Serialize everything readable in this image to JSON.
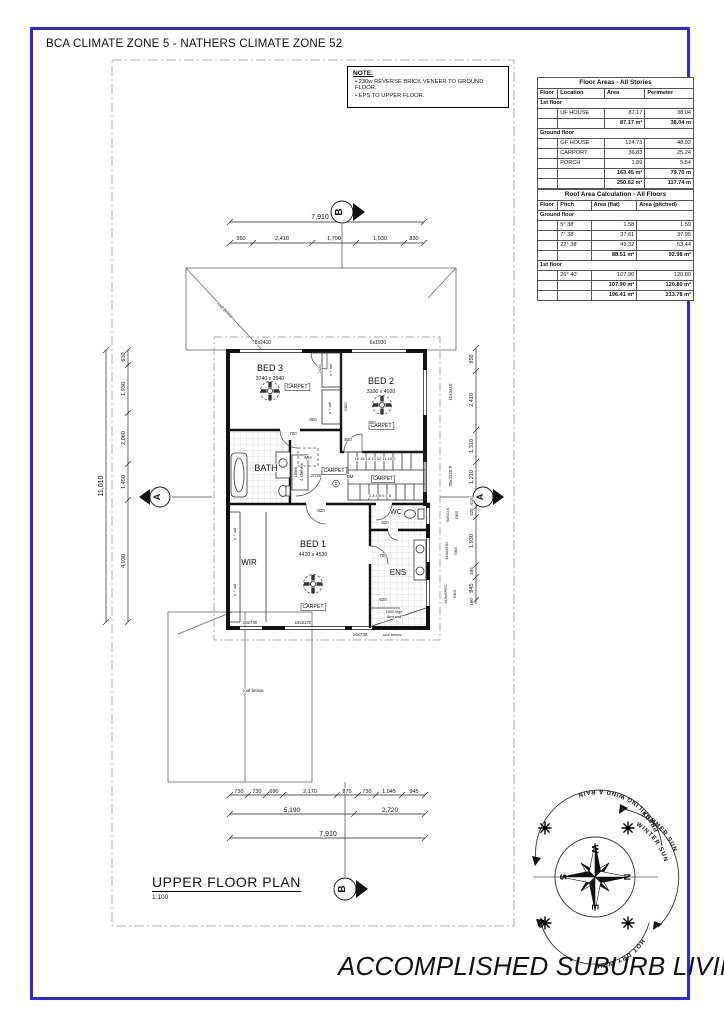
{
  "page": {
    "border_color": "#2b2bdd"
  },
  "header": {
    "text": "BCA CLIMATE ZONE 5 - NATHERS CLIMATE ZONE 52"
  },
  "note": {
    "title": "NOTE:",
    "items": [
      "230w REVERSE BRICK VENEER TO GROUND FLOOR.",
      "EPS TO UPPER FLOOR."
    ]
  },
  "tables": {
    "floor_areas": {
      "title": "Floor Areas - All Stories",
      "columns": [
        "Floor",
        "Location",
        "Area",
        "Perimeter"
      ],
      "rows": [
        {
          "type": "section",
          "label": "1st floor"
        },
        {
          "type": "data",
          "cells": [
            "",
            "UF HOUSE",
            "87.17",
            "38.04"
          ]
        },
        {
          "type": "subtotal",
          "cells": [
            "",
            "",
            "87.17 m²",
            "38.04 m"
          ]
        },
        {
          "type": "section",
          "label": "Ground floor"
        },
        {
          "type": "data",
          "cells": [
            "",
            "GF HOUSE",
            "124.73",
            "48.92"
          ]
        },
        {
          "type": "data",
          "cells": [
            "",
            "CARPORT",
            "36.83",
            "25.24"
          ]
        },
        {
          "type": "data",
          "cells": [
            "",
            "PORCH",
            "1.89",
            "5.54"
          ]
        },
        {
          "type": "subtotal",
          "cells": [
            "",
            "",
            "163.45 m²",
            "79.70 m"
          ]
        },
        {
          "type": "total",
          "cells": [
            "",
            "",
            "250.62 m²",
            "117.74 m"
          ]
        }
      ]
    },
    "roof_areas": {
      "title": "Roof Area Calculation - All Floors",
      "columns": [
        "Floor",
        "Pitch",
        "Area (flat)",
        "Area (pitched)"
      ],
      "rows": [
        {
          "type": "section",
          "label": "Ground floor"
        },
        {
          "type": "data",
          "cells": [
            "",
            "5° 38'",
            "1.58",
            "1.59"
          ]
        },
        {
          "type": "data",
          "cells": [
            "",
            "7° 38'",
            "37.61",
            "37.95"
          ]
        },
        {
          "type": "data",
          "cells": [
            "",
            "22° 38'",
            "49.32",
            "53.44"
          ]
        },
        {
          "type": "subtotal",
          "cells": [
            "",
            "",
            "88.51 m²",
            "92.98 m²"
          ]
        },
        {
          "type": "section",
          "label": "1st floor"
        },
        {
          "type": "data",
          "cells": [
            "",
            "26° 40'",
            "107.90",
            "120.80"
          ]
        },
        {
          "type": "subtotal",
          "cells": [
            "",
            "",
            "107.90 m²",
            "120.80 m²"
          ]
        },
        {
          "type": "total",
          "cells": [
            "",
            "",
            "196.41 m²",
            "213.78 m²"
          ]
        }
      ]
    }
  },
  "plan": {
    "title": "UPPER FLOOR PLAN",
    "scale": "1:100",
    "labels": [
      {
        "t": "7,910",
        "x": 320,
        "y": 219,
        "s": 7,
        "n": "dim-top-overall"
      },
      {
        "t": "950",
        "x": 241,
        "y": 240,
        "s": 5.5,
        "n": "dim-top"
      },
      {
        "t": "2,410",
        "x": 282,
        "y": 240,
        "s": 5.5,
        "n": "dim-top"
      },
      {
        "t": "1,790",
        "x": 334,
        "y": 240,
        "s": 5.5,
        "n": "dim-top"
      },
      {
        "t": "1,930",
        "x": 380,
        "y": 240,
        "s": 5.5,
        "n": "dim-top"
      },
      {
        "t": "830",
        "x": 414,
        "y": 240,
        "s": 5.5,
        "n": "dim-top"
      },
      {
        "t": "11,010",
        "x": 103,
        "y": 486,
        "r": -90,
        "s": 7,
        "n": "dim-left-overall"
      },
      {
        "t": "610",
        "x": 125,
        "y": 357,
        "r": -90,
        "s": 5.5,
        "n": "dim-left"
      },
      {
        "t": "1,930",
        "x": 125,
        "y": 389,
        "r": -90,
        "s": 5.5,
        "n": "dim-left"
      },
      {
        "t": "2,060",
        "x": 125,
        "y": 438,
        "r": -90,
        "s": 5.5,
        "n": "dim-left"
      },
      {
        "t": "1,450",
        "x": 125,
        "y": 482,
        "r": -90,
        "s": 5.5,
        "n": "dim-left"
      },
      {
        "t": "4,930",
        "x": 125,
        "y": 561,
        "r": -90,
        "s": 5.5,
        "n": "dim-left"
      },
      {
        "t": "950",
        "x": 473,
        "y": 359,
        "r": -90,
        "s": 5.5,
        "n": "dim-right"
      },
      {
        "t": "2,410",
        "x": 473,
        "y": 400,
        "r": -90,
        "s": 5.5,
        "n": "dim-right"
      },
      {
        "t": "1,310",
        "x": 473,
        "y": 446,
        "r": -90,
        "s": 5.5,
        "n": "dim-right"
      },
      {
        "t": "1,210",
        "x": 473,
        "y": 477,
        "r": -90,
        "s": 5.5,
        "n": "dim-right"
      },
      {
        "t": "615",
        "x": 473,
        "y": 501,
        "r": -90,
        "s": 4.5,
        "n": "dim-right"
      },
      {
        "t": "425",
        "x": 473,
        "y": 512,
        "r": -90,
        "s": 4.5,
        "n": "dim-right"
      },
      {
        "t": "1,930",
        "x": 473,
        "y": 541,
        "r": -90,
        "s": 5.5,
        "n": "dim-right"
      },
      {
        "t": "495",
        "x": 473,
        "y": 571,
        "r": -90,
        "s": 4.5,
        "n": "dim-right"
      },
      {
        "t": "945",
        "x": 473,
        "y": 588,
        "r": -90,
        "s": 5.5,
        "n": "dim-right"
      },
      {
        "t": "160",
        "x": 473,
        "y": 602,
        "r": -90,
        "s": 4.5,
        "n": "dim-right"
      },
      {
        "t": "730",
        "x": 239,
        "y": 793,
        "s": 5.5,
        "n": "dim-bottom"
      },
      {
        "t": "730",
        "x": 257,
        "y": 793,
        "s": 5.5,
        "n": "dim-bottom"
      },
      {
        "t": "690",
        "x": 274,
        "y": 793,
        "s": 5.5,
        "n": "dim-bottom"
      },
      {
        "t": "2,170",
        "x": 310,
        "y": 793,
        "s": 5.5,
        "n": "dim-bottom"
      },
      {
        "t": "870",
        "x": 347,
        "y": 793,
        "s": 5.5,
        "n": "dim-bottom"
      },
      {
        "t": "730",
        "x": 367,
        "y": 793,
        "s": 5.5,
        "n": "dim-bottom"
      },
      {
        "t": "1,045",
        "x": 389,
        "y": 793,
        "s": 5.5,
        "n": "dim-bottom"
      },
      {
        "t": "945",
        "x": 414,
        "y": 793,
        "s": 5.5,
        "n": "dim-bottom"
      },
      {
        "t": "5,190",
        "x": 292,
        "y": 812,
        "s": 6.5,
        "n": "dim-bottom"
      },
      {
        "t": "2,720",
        "x": 390,
        "y": 812,
        "s": 6.5,
        "n": "dim-bottom"
      },
      {
        "t": "7,910",
        "x": 328,
        "y": 836,
        "s": 7,
        "n": "dim-bottom-overall"
      },
      {
        "t": "BED 3",
        "x": 270,
        "y": 371,
        "s": 9,
        "n": "room-bed3"
      },
      {
        "t": "3740 x 2940",
        "x": 270,
        "y": 380,
        "s": 5.2,
        "n": "room-bed3-size"
      },
      {
        "t": "CARPET",
        "x": 297,
        "y": 388,
        "s": 5.2,
        "box": true,
        "n": "finish-carpet"
      },
      {
        "t": "BED 2",
        "x": 381,
        "y": 384,
        "s": 9,
        "n": "room-bed2"
      },
      {
        "t": "3100 x 4020",
        "x": 381,
        "y": 393,
        "s": 5.2,
        "n": "room-bed2-size"
      },
      {
        "t": "CARPET",
        "x": 381,
        "y": 427,
        "s": 5.2,
        "box": true,
        "n": "finish-carpet"
      },
      {
        "t": "BATH",
        "x": 266,
        "y": 471,
        "s": 9,
        "n": "room-bath"
      },
      {
        "t": "Linen",
        "x": 297,
        "y": 472,
        "r": -90,
        "s": 4.2,
        "n": "linen-label"
      },
      {
        "t": "4 shelves",
        "x": 303,
        "y": 472,
        "r": -90,
        "s": 4.2,
        "n": "linen-shelves-label"
      },
      {
        "t": "CARPET",
        "x": 334,
        "y": 472,
        "s": 5.2,
        "box": true,
        "n": "finish-carpet"
      },
      {
        "t": "MH",
        "x": 308,
        "y": 459,
        "s": 4.6,
        "n": "manhole-label"
      },
      {
        "t": "DM",
        "x": 350,
        "y": 478,
        "s": 4.4,
        "n": "dm-label"
      },
      {
        "t": "S",
        "x": 336,
        "y": 485,
        "s": 4.4,
        "n": "smoke-alarm-label"
      },
      {
        "t": "2/720",
        "x": 316,
        "y": 477,
        "s": 4.4,
        "n": "door-size"
      },
      {
        "t": "CARPET",
        "x": 383,
        "y": 480,
        "s": 5,
        "box": true,
        "n": "finish-carpet"
      },
      {
        "t": "16 15 14 13 12 11 10 9",
        "x": 375,
        "y": 460,
        "s": 4,
        "n": "stair-treads-upper"
      },
      {
        "t": "2 3 4 5 6 7 8",
        "x": 380,
        "y": 497,
        "s": 4,
        "n": "stair-treads-lower"
      },
      {
        "t": "WIR",
        "x": 249,
        "y": 565,
        "s": 8,
        "n": "room-wir"
      },
      {
        "t": "BED 1",
        "x": 313,
        "y": 547,
        "s": 9,
        "n": "room-bed1"
      },
      {
        "t": "4420 x 4530",
        "x": 313,
        "y": 556,
        "s": 5.2,
        "n": "room-bed1-size"
      },
      {
        "t": "CARPET",
        "x": 313,
        "y": 608,
        "s": 5.2,
        "box": true,
        "n": "finish-carpet"
      },
      {
        "t": "WC",
        "x": 396,
        "y": 514,
        "s": 7,
        "n": "room-wc"
      },
      {
        "t": "ENS",
        "x": 398,
        "y": 575,
        "s": 8,
        "n": "room-ens"
      },
      {
        "t": "620",
        "x": 385,
        "y": 524,
        "s": 4.4,
        "n": "door-size"
      },
      {
        "t": "720",
        "x": 383,
        "y": 557,
        "s": 4.4,
        "n": "door-size"
      },
      {
        "t": "620",
        "x": 383,
        "y": 601,
        "s": 4.4,
        "n": "door-size"
      },
      {
        "t": "1000 high",
        "x": 394,
        "y": 613,
        "s": 3.8,
        "n": "tiled-wall-note"
      },
      {
        "t": "tiled wall",
        "x": 394,
        "y": 618,
        "s": 3.8,
        "n": "tiled-wall-note"
      },
      {
        "t": "820",
        "x": 321,
        "y": 512,
        "s": 4.4,
        "n": "door-size"
      },
      {
        "t": "820",
        "x": 313,
        "y": 421,
        "s": 4.4,
        "n": "door-size"
      },
      {
        "t": "720",
        "x": 293,
        "y": 435,
        "s": 4.4,
        "n": "door-size"
      },
      {
        "t": "820",
        "x": 348,
        "y": 441,
        "s": 4.4,
        "n": "door-size"
      },
      {
        "t": "820",
        "x": 372,
        "y": 424,
        "s": 4.4,
        "n": "door-size"
      },
      {
        "t": "2420",
        "x": 321,
        "y": 369,
        "r": -90,
        "s": 4,
        "n": "robe-size"
      },
      {
        "t": "s + rail",
        "x": 332,
        "y": 370,
        "r": -90,
        "s": 4,
        "n": "robe-label"
      },
      {
        "t": "2450",
        "x": 347,
        "y": 407,
        "r": -90,
        "s": 4,
        "n": "robe-size"
      },
      {
        "t": "s + rail",
        "x": 331,
        "y": 408,
        "r": -90,
        "s": 4,
        "n": "robe-label"
      },
      {
        "t": "s + rail",
        "x": 236,
        "y": 534,
        "r": -90,
        "s": 4,
        "n": "robe-label"
      },
      {
        "t": "s + rail",
        "x": 236,
        "y": 590,
        "r": -90,
        "s": 4,
        "n": "robe-label"
      },
      {
        "t": "8x2410",
        "x": 263,
        "y": 344,
        "s": 5,
        "n": "window-tag"
      },
      {
        "t": "6x1930",
        "x": 378,
        "y": 344,
        "s": 5,
        "n": "window-tag"
      },
      {
        "t": "16x730",
        "x": 250,
        "y": 624,
        "s": 4.4,
        "n": "window-tag"
      },
      {
        "t": "16x2170",
        "x": 303,
        "y": 624,
        "s": 4.4,
        "n": "window-tag"
      },
      {
        "t": "16x730",
        "x": 360,
        "y": 636,
        "s": 4.4,
        "n": "window-tag"
      },
      {
        "t": "roof below",
        "x": 392,
        "y": 636,
        "s": 4,
        "n": "roof-below-label"
      },
      {
        "t": "10x3410",
        "x": 452,
        "y": 392,
        "r": -90,
        "s": 4.4,
        "n": "window-tag"
      },
      {
        "t": "25x1210  F",
        "x": 452,
        "y": 476,
        "r": -90,
        "s": 4.4,
        "n": "window-tag"
      },
      {
        "t": "9x610  A",
        "x": 449,
        "y": 515,
        "r": -90,
        "s": 4,
        "n": "window-tag"
      },
      {
        "t": "OBS",
        "x": 458,
        "y": 515,
        "r": -90,
        "s": 4,
        "n": "window-obs-tag"
      },
      {
        "t": "343x1930",
        "x": 448,
        "y": 551,
        "r": -90,
        "s": 4,
        "n": "window-tag"
      },
      {
        "t": "OBS",
        "x": 457,
        "y": 551,
        "r": -90,
        "s": 4,
        "n": "window-obs-tag"
      },
      {
        "t": "343xSPEC",
        "x": 447,
        "y": 594,
        "r": -90,
        "s": 4,
        "n": "window-tag"
      },
      {
        "t": "OBS",
        "x": 456,
        "y": 594,
        "r": -90,
        "s": 4,
        "n": "window-obs-tag"
      },
      {
        "t": "roof below",
        "x": 224,
        "y": 311,
        "r": 45,
        "s": 4.5,
        "n": "roof-below-label"
      },
      {
        "t": "roof below",
        "x": 253,
        "y": 692,
        "s": 4.5,
        "n": "roof-below-label"
      },
      {
        "t": "B",
        "x": 342,
        "y": 212,
        "r": -90,
        "s": 10,
        "b": true,
        "n": "section-marker-b-letter"
      },
      {
        "t": "B",
        "x": 345,
        "y": 889,
        "r": -90,
        "s": 10,
        "b": true,
        "n": "section-marker-b-letter"
      },
      {
        "t": "A",
        "x": 160,
        "y": 497,
        "r": -90,
        "s": 9,
        "b": true,
        "n": "section-marker-a-letter"
      },
      {
        "t": "A",
        "x": 483,
        "y": 497,
        "r": -90,
        "s": 9,
        "b": true,
        "n": "section-marker-a-letter"
      }
    ]
  },
  "compass": {
    "north": "N",
    "south": "S",
    "east": "E",
    "west": "W",
    "arc_top": "PREVAILING WIND & RAIN",
    "arc_right_outer": "SUMMER SUN",
    "arc_right_inner": "WINTER SUN",
    "arc_bottom": "HOT DRY WIND"
  },
  "footer": {
    "title": "ACCOMPLISHED SUBURB LIVING"
  }
}
